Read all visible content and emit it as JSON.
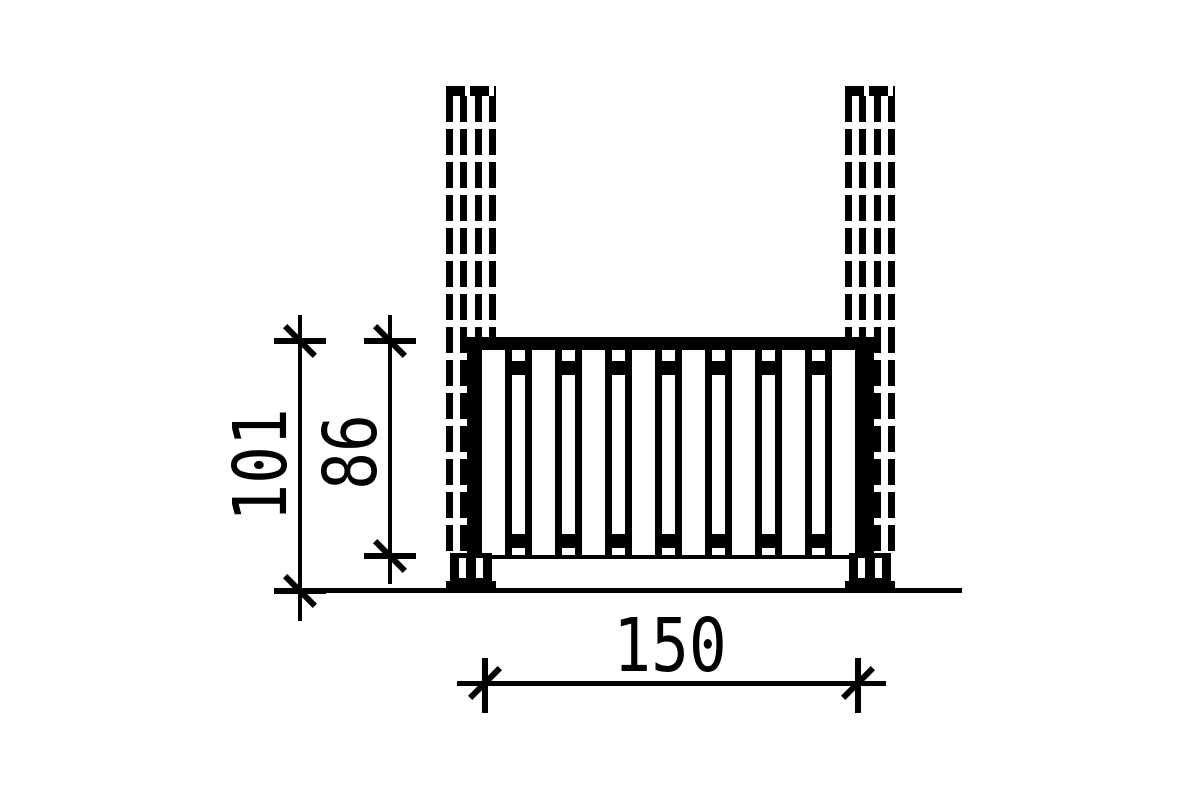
{
  "drawing": {
    "type": "technical elevation drawing",
    "subject": "balustrade railing mounted between two posts",
    "background_color": "#ffffff",
    "line_color": "#000000"
  },
  "dims": {
    "overall_height": {
      "label": "101",
      "orientation": "vertical"
    },
    "railing_height": {
      "label": "86",
      "orientation": "vertical"
    },
    "railing_width": {
      "label": "150",
      "orientation": "horizontal"
    }
  },
  "structure": {
    "posts": {
      "count": 2,
      "dashed_lines_per_post": 4,
      "line_style": "dashed"
    },
    "railing": {
      "wide_slats": 8,
      "narrow_slats": 7,
      "has_top_rail": true,
      "has_bottom_plank": true
    },
    "post_anchors": {
      "count": 2
    },
    "ground_line": true
  }
}
